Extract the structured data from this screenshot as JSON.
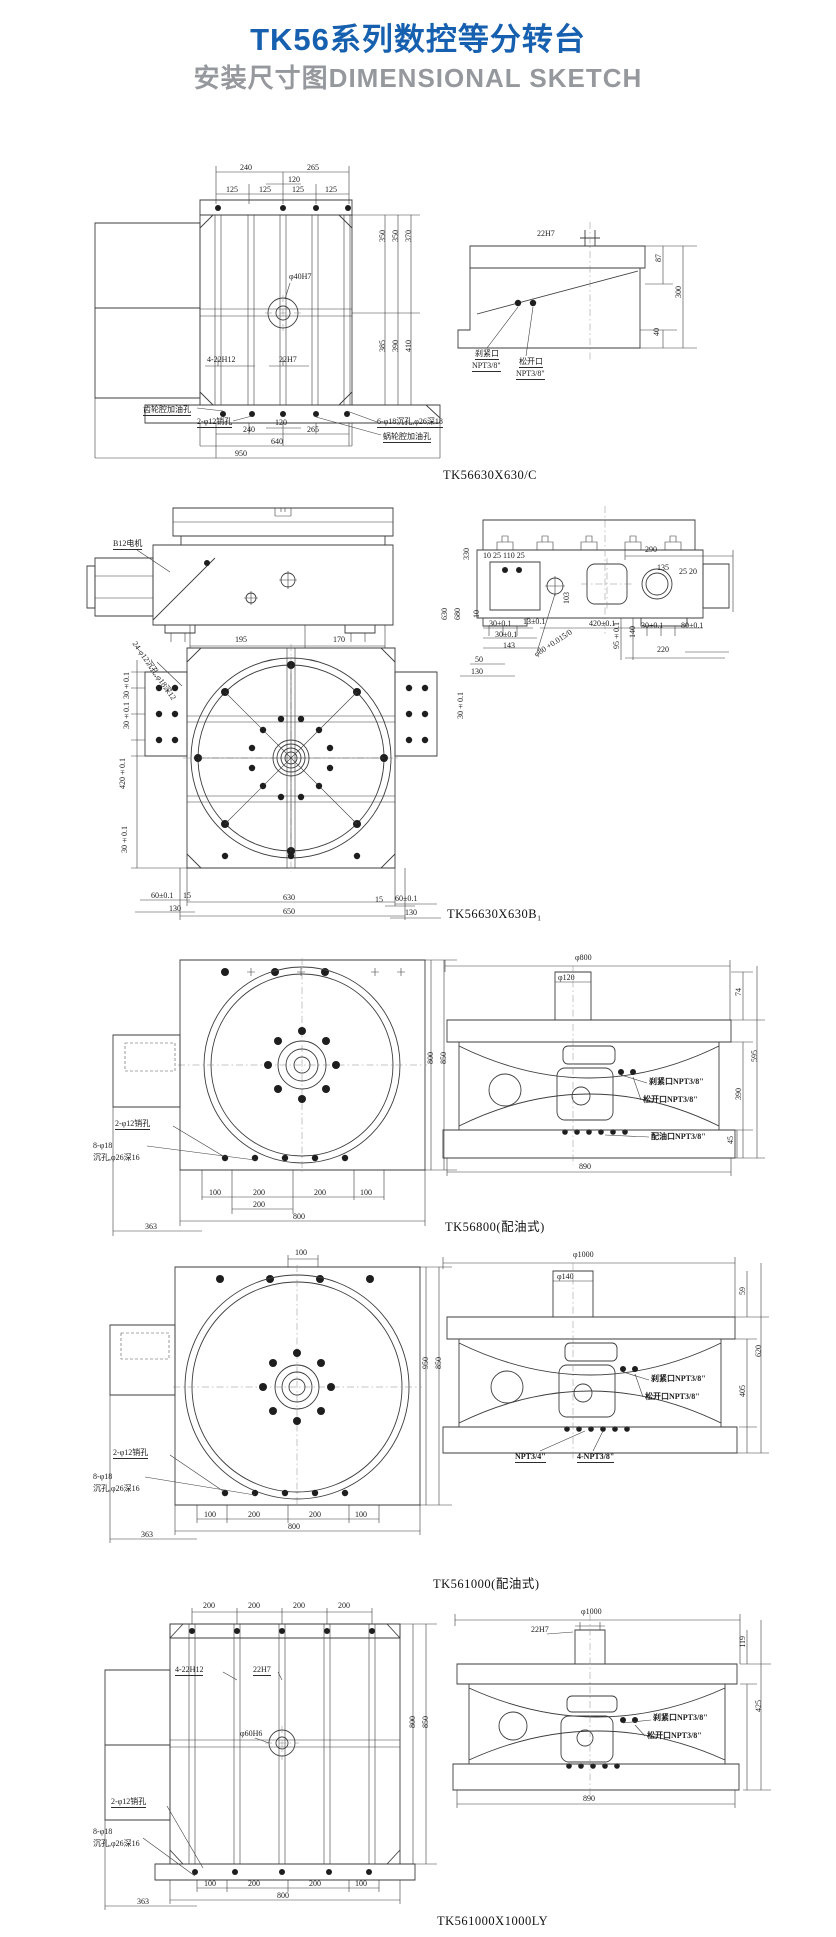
{
  "header": {
    "title": "TK56系列数控等分转台",
    "subtitle": "安装尺寸图DIMENSIONAL SKETCH"
  },
  "colors": {
    "title_blue": "#1660af",
    "subtitle_gray": "#95989c",
    "line": "#3d3d3d"
  },
  "figures": [
    {
      "caption": "TK56630X630/C",
      "ann": {
        "d240": "240",
        "d265": "265",
        "d120": "120",
        "d125a": "125",
        "d125b": "125",
        "d125c": "125",
        "d125d": "125",
        "phi40": "φ40H7",
        "h422": "4-22H12",
        "h22": "22H7",
        "v350a": "350",
        "v350b": "350",
        "v370": "370",
        "v385": "385",
        "v390": "390",
        "v410": "410",
        "s22h7": "22H7",
        "v87": "87",
        "v300": "300",
        "v40": "40",
        "brake1": "刹紧口",
        "brake2": "NPT3/8\"",
        "rel1": "松开口",
        "rel2": "NPT3/8\"",
        "gear_oil": "齿轮腔加油孔",
        "pin": "2-φ12销孔",
        "b120": "120",
        "b240": "240",
        "b265": "265",
        "b640": "640",
        "b950": "950",
        "sink": "6-φ18沉孔,φ26深18",
        "worm": "蜗轮腔加油孔"
      }
    },
    {
      "caption": "TK56630X630B₁",
      "ann": {
        "motor": "B12电机",
        "d195": "195",
        "d170": "170",
        "diag": "24-φ12沉孔,φ18深12",
        "v330": "330",
        "row": "10 25 110 25",
        "d290": "290",
        "d135": "135",
        "d2520": "25 20",
        "v103": "103",
        "v10": "10",
        "t30a": "30±0.1",
        "t30b": "30±0.1",
        "d143": "143",
        "d13": "13±0.1",
        "d420": "420±0.1",
        "v95": "95±0.1",
        "v140": "140",
        "t30c": "30±0.1",
        "t80": "80±0.1",
        "d220": "220",
        "phi80": "φ80 +0.015/0",
        "d50": "50",
        "d130": "130",
        "l30a": "30±0.1",
        "l30b": "30±0.1",
        "lv420": "420±0.1",
        "l30c": "30±0.1",
        "rv630": "630",
        "rv680": "680",
        "r30": "30±0.1",
        "b15l": "15",
        "b60l": "60±0.1",
        "b130l": "130",
        "b630": "630",
        "b650": "650",
        "b15r": "15",
        "b60r": "60±0.1",
        "b130r": "130"
      }
    },
    {
      "caption": "TK56800(配油式)",
      "ann": {
        "phi800": "φ800",
        "phi120": "φ120",
        "v74": "74",
        "v595": "595",
        "v390": "390",
        "v45": "45",
        "b890": "890",
        "brake": "刹紧口NPT3/8\"",
        "release": "松开口NPT3/8\"",
        "dist": "配油口NPT3/8\"",
        "pin": "2-φ12销孔",
        "sink1": "8-φ18",
        "sink2": "沉孔,φ26深16",
        "b100a": "100",
        "b200a": "200",
        "b200b": "200",
        "b100b": "100",
        "b200c": "200",
        "b800": "800",
        "b363": "363",
        "v800": "800",
        "v850": "850"
      }
    },
    {
      "caption": "TK561000(配油式)",
      "ann": {
        "t100": "100",
        "phi1000": "φ1000",
        "phi140": "φ140",
        "v59": "59",
        "v620": "620",
        "v405": "405",
        "brake": "刹紧口NPT3/8\"",
        "release": "松开口NPT3/8\"",
        "npt34": "NPT3/4\"",
        "npt38": "4-NPT3/8\"",
        "pin": "2-φ12销孔",
        "sink1": "8-φ18",
        "sink2": "沉孔,φ26深16",
        "b100a": "100",
        "b200a": "200",
        "b200b": "200",
        "b100b": "100",
        "b800": "800",
        "b363": "363",
        "v950": "950",
        "v850": "850"
      }
    },
    {
      "caption": "TK561000X1000LY",
      "ann": {
        "t200a": "200",
        "t200b": "200",
        "t200c": "200",
        "t200d": "200",
        "h422": "4-22H12",
        "h22": "22H7",
        "phi60": "φ60H6",
        "pin": "2-φ12销孔",
        "sink1": "8-φ18",
        "sink2": "沉孔,φ26深16",
        "b100a": "100",
        "b200a": "200",
        "b200b": "200",
        "b100b": "100",
        "b800": "800",
        "b363": "363",
        "v800": "800",
        "v850": "850",
        "phi1000": "φ1000",
        "s22h7": "22H7",
        "v119": "119",
        "v425": "425",
        "b890": "890",
        "brake": "刹紧口NPT3/8\"",
        "release": "松开口NPT3/8\""
      }
    }
  ]
}
